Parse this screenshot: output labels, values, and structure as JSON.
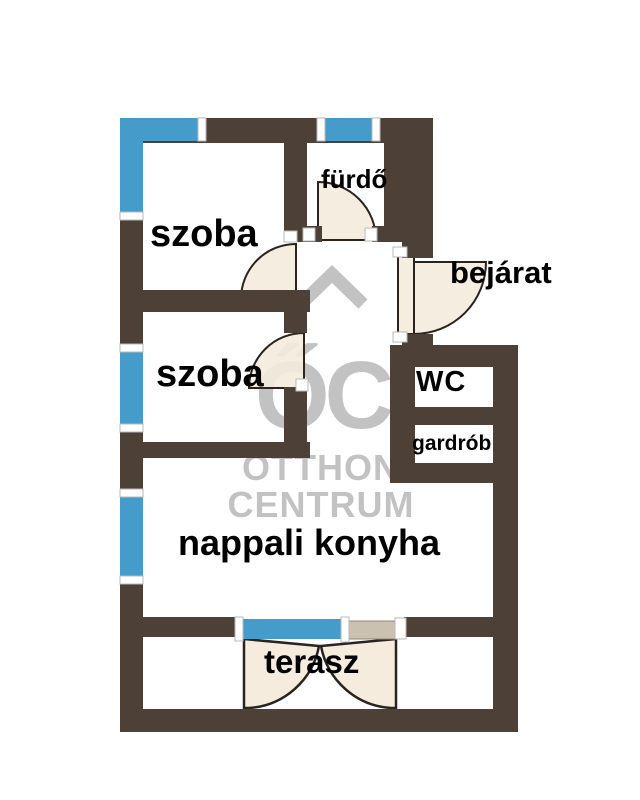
{
  "brand": {
    "logo_text": "ŐC",
    "name_line1": "OTTHON",
    "name_line2": "CENTRUM"
  },
  "rooms": {
    "szoba_top": {
      "label": "szoba"
    },
    "szoba_middle": {
      "label": "szoba"
    },
    "furdo": {
      "label": "fürdő"
    },
    "bejarat": {
      "label": "bejárat"
    },
    "wc": {
      "label": "WC"
    },
    "gardrob": {
      "label": "gardrób"
    },
    "nappali_konyha": {
      "label": "nappali konyha"
    },
    "terasz": {
      "label": "terasz"
    }
  },
  "colors": {
    "wall": "#4d4036",
    "window": "#459bca",
    "door": "#f4ebdc",
    "door_outline": "#2b241e",
    "panel": "#cbc1b1",
    "watermark": "#c2c2c2",
    "label_text": "#000000",
    "background": "#ffffff"
  }
}
